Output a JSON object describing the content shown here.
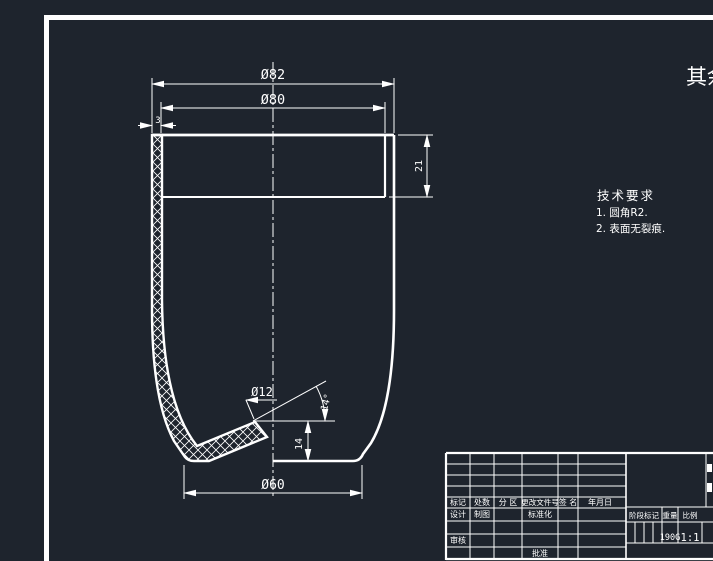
{
  "app": {
    "background_color": "#1e242d",
    "line_color": "#ffffff",
    "note_color": "#f4f418"
  },
  "drawing": {
    "dims": {
      "top_outer_diameter": "Ø82",
      "top_inner_diameter": "Ø80",
      "wall_thickness": "3",
      "rim_height": "21",
      "hole_diameter": "Ø12",
      "cone_angle": "14°",
      "hole_height": "14",
      "base_diameter": "Ø60"
    },
    "tech_req": {
      "title": "技术要求",
      "item1": "1. 圆角R2.",
      "item2": "2. 表面无裂痕."
    },
    "corner_note": "其余"
  },
  "title_block": {
    "rev_header": {
      "mark": "标记",
      "count": "处数",
      "zone": "分 区",
      "change_doc_no": "更改文件号",
      "signature": "签 名",
      "date": "年月日"
    },
    "labels": {
      "design": "设计",
      "draft": "制图",
      "standardization": "标准化",
      "audit": "审核",
      "approve": "批准",
      "stage_mark": "阶段标记",
      "weight_label": "重量",
      "scale_label": "比例"
    },
    "values": {
      "weight": "190G",
      "scale": "1:1"
    }
  }
}
